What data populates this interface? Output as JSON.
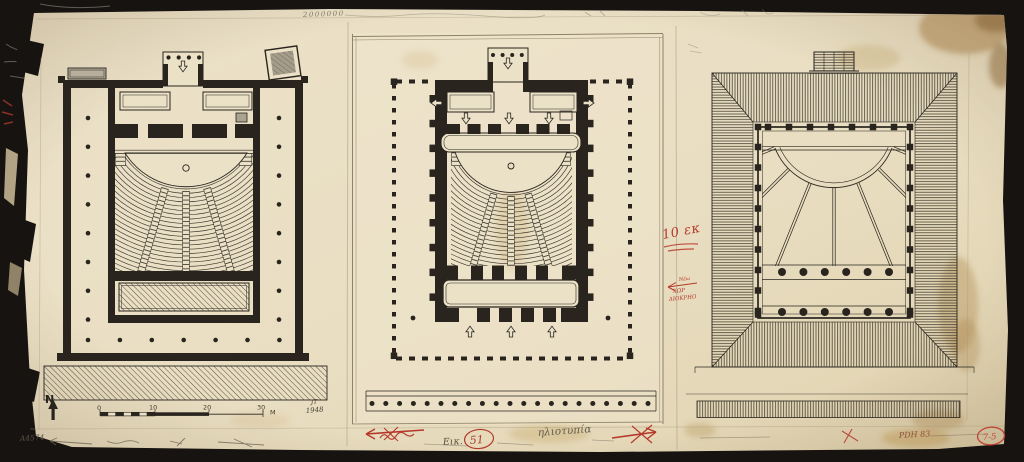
{
  "sheet": {
    "annotations": {
      "top_scribble": "2000000",
      "north_label": "N",
      "author_initials": "JT",
      "year": "1948",
      "inventory_code_left": "A4574",
      "figure_caption": "Εικ.",
      "figure_number": "51",
      "media_note": "ηλιοτυπία",
      "red_dimension_note": "10 εκ",
      "red_note_line1": "Νέω",
      "red_note_line2": "ΧΩΡ",
      "red_note_line3": "ΔΙΟΚΡΗΟ",
      "inventory_code_right": "PDH 83",
      "red_stamp": "7-5"
    },
    "scale_bar": {
      "ticks": [
        "0",
        "10",
        "20",
        "30"
      ],
      "unit": "M"
    },
    "colors": {
      "background": "#171310",
      "paper": "#e9dec4",
      "ink": "#29251e",
      "red_pencil": "#b5392b",
      "graphite": "#6b6355"
    }
  }
}
